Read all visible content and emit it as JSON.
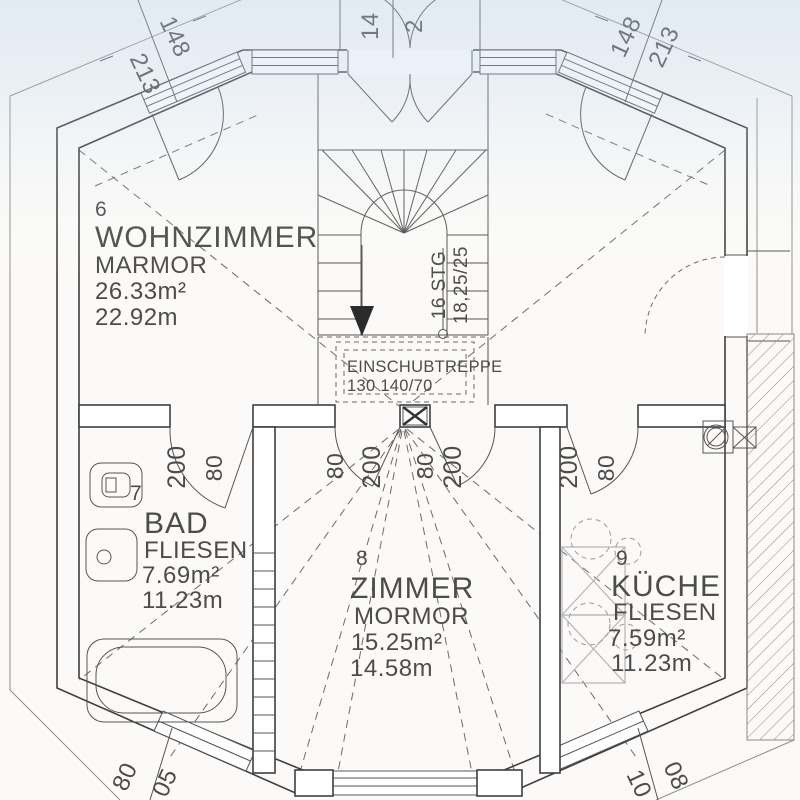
{
  "plan": {
    "rooms": [
      {
        "number": "6",
        "name": "WOHNZIMMER",
        "floor": "MARMOR",
        "area": "26.33m²",
        "circumference": "22.92m"
      },
      {
        "number": "7",
        "name": "BAD",
        "floor": "FLIESEN",
        "area": "7.69m²",
        "circumference": "11.23m"
      },
      {
        "number": "8",
        "name": "ZIMMER",
        "floor": "MORMOR",
        "area": "15.25m²",
        "circumference": "14.58m"
      },
      {
        "number": "9",
        "name": "KÜCHE",
        "floor": "FLIESEN",
        "area": "7.59m²",
        "circumference": "11.23m"
      }
    ],
    "stairs": {
      "label": "16 STG",
      "dimensions": "18,25/25"
    },
    "attic_ladder": {
      "label": "EINSCHUBTREPPE",
      "dimensions": "130 140/70"
    },
    "dims": {
      "top_left": [
        "148",
        "213"
      ],
      "top_center": [
        "14",
        "2"
      ],
      "top_right": [
        "148",
        "213"
      ],
      "bad_door": [
        "200",
        "80"
      ],
      "room_door_left": [
        "80",
        "200"
      ],
      "room_door_right": [
        "80",
        "200"
      ],
      "kitchen_door": [
        "200",
        "80"
      ],
      "bottom_left": [
        "80",
        "05"
      ],
      "bottom_right": [
        "10",
        "08"
      ]
    }
  }
}
